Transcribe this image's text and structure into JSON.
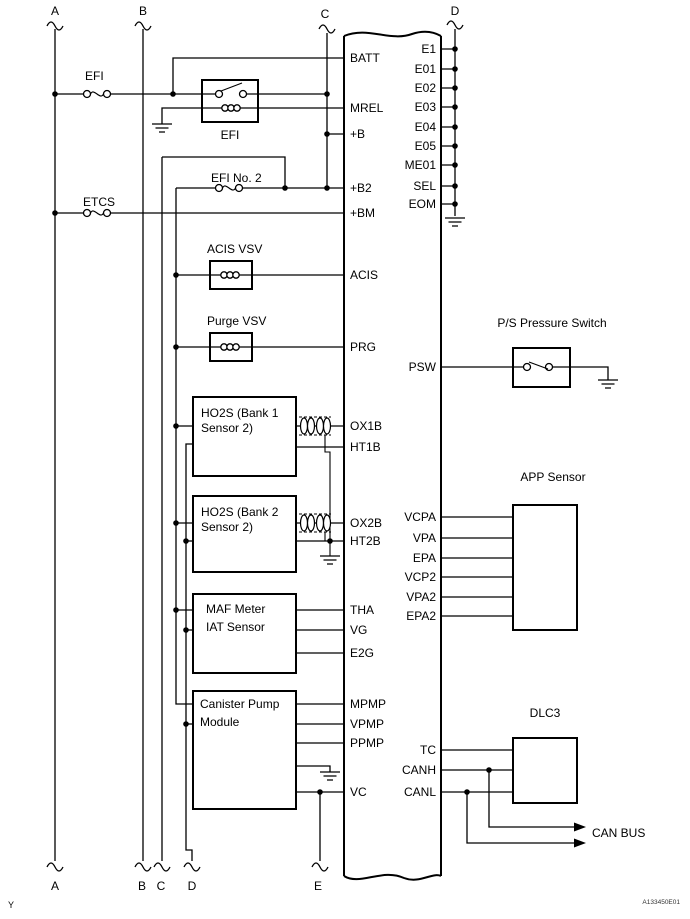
{
  "diagram": {
    "page_mark": "Y",
    "doc_code": "A133450E01",
    "top_connectors": {
      "a": "A",
      "b": "B",
      "c": "C",
      "d": "D"
    },
    "bottom_connectors": {
      "a": "A",
      "b": "B",
      "c": "C",
      "d": "D",
      "e": "E"
    },
    "fuses": {
      "efi": "EFI",
      "etcs": "ETCS",
      "efi_no2": "EFI No. 2"
    },
    "relay": {
      "label": "EFI"
    },
    "components": {
      "acis_vsv": "ACIS VSV",
      "purge_vsv": "Purge VSV",
      "ho2s_b1_line1": "HO2S (Bank 1",
      "ho2s_b1_line2": "Sensor 2)",
      "ho2s_b2_line1": "HO2S (Bank 2",
      "ho2s_b2_line2": "Sensor 2)",
      "maf_line1": "MAF Meter",
      "maf_line2": "IAT Sensor",
      "canister_line1": "Canister Pump",
      "canister_line2": "Module",
      "ps_switch": "P/S Pressure Switch",
      "app_sensor": "APP Sensor",
      "dlc3": "DLC3",
      "can_bus": "CAN BUS"
    },
    "ecm_left_pins": {
      "batt": "BATT",
      "mrel": "MREL",
      "b_plus": "+B",
      "b2_plus": "+B2",
      "bm_plus": "+BM",
      "acis": "ACIS",
      "prg": "PRG",
      "ox1b": "OX1B",
      "ht1b": "HT1B",
      "ox2b": "OX2B",
      "ht2b": "HT2B",
      "tha": "THA",
      "vg": "VG",
      "e2g": "E2G",
      "mpmp": "MPMP",
      "vpmp": "VPMP",
      "ppmp": "PPMP",
      "vc": "VC"
    },
    "ecm_right_pins": {
      "e1": "E1",
      "e01": "E01",
      "e02": "E02",
      "e03": "E03",
      "e04": "E04",
      "e05": "E05",
      "me01": "ME01",
      "sel": "SEL",
      "eom": "EOM",
      "psw": "PSW",
      "vcpa": "VCPA",
      "vpa": "VPA",
      "epa": "EPA",
      "vcp2": "VCP2",
      "vpa2": "VPA2",
      "epa2": "EPA2",
      "tc": "TC",
      "canh": "CANH",
      "canl": "CANL"
    }
  }
}
